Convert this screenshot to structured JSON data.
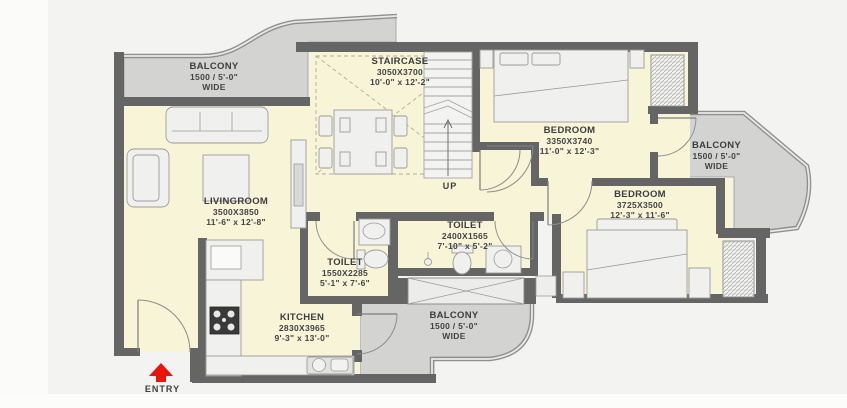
{
  "plan": {
    "title": "2BHK apartment floor plan",
    "rooms": [
      {
        "id": "balcony-top-left",
        "name": "BALCONY",
        "dim1": "1500 / 5'-0\"",
        "dim2": "WIDE"
      },
      {
        "id": "staircase",
        "name": "STAIRCASE",
        "dim1": "3050X3700",
        "dim2": "10'-0\" x 12'-2\""
      },
      {
        "id": "bedroom-1",
        "name": "BEDROOM",
        "dim1": "3350X3740",
        "dim2": "11'-0\" x 12'-3\""
      },
      {
        "id": "balcony-right",
        "name": "BALCONY",
        "dim1": "1500 / 5'-0\"",
        "dim2": "WIDE"
      },
      {
        "id": "bedroom-2",
        "name": "BEDROOM",
        "dim1": "3725X3500",
        "dim2": "12'-3\" x 11'-6\""
      },
      {
        "id": "toilet-2",
        "name": "TOILET",
        "dim1": "2400X1565",
        "dim2": "7'-10\" x 5'-2\""
      },
      {
        "id": "toilet-1",
        "name": "TOILET",
        "dim1": "1550X2285",
        "dim2": "5'-1\" x 7'-6\""
      },
      {
        "id": "kitchen",
        "name": "KITCHEN",
        "dim1": "2830X3965",
        "dim2": "9'-3\" x 13'-0\""
      },
      {
        "id": "balcony-bottom",
        "name": "BALCONY",
        "dim1": "1500 / 5'-0\"",
        "dim2": "WIDE"
      },
      {
        "id": "livingroom",
        "name": "LIVINGROOM",
        "dim1": "3500X3850",
        "dim2": "11'-6\" x 12'-8\""
      }
    ],
    "annotations": {
      "up_label": "UP",
      "entry_label": "ENTRY"
    },
    "colors": {
      "wall": "#656565",
      "floor": "#f7f4d8",
      "balcony_floor": "#d3d3d1",
      "background": "#f3f3f1",
      "entry_arrow": "#e8150a",
      "text": "#3d3d3d"
    }
  }
}
